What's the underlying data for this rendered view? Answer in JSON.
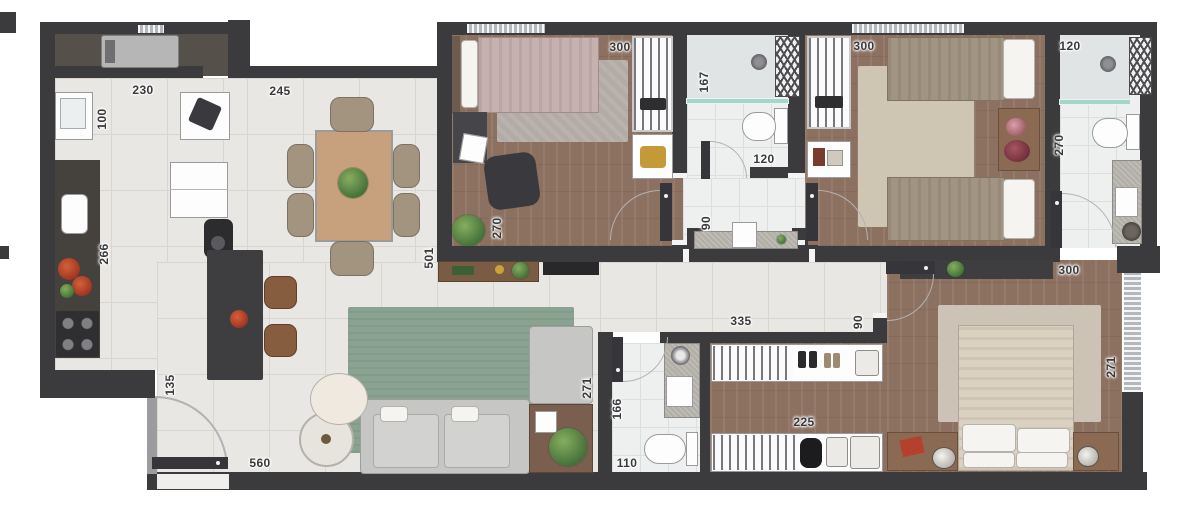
{
  "plan": {
    "kind": "residential apartment floor plan, top-down furnished render",
    "dimension_labels": [
      {
        "text": "230",
        "x": 143,
        "y": 90,
        "rot": 0
      },
      {
        "text": "100",
        "x": 102,
        "y": 119,
        "rot": -90
      },
      {
        "text": "245",
        "x": 280,
        "y": 91,
        "rot": 0
      },
      {
        "text": "266",
        "x": 104,
        "y": 254,
        "rot": -90
      },
      {
        "text": "135",
        "x": 170,
        "y": 385,
        "rot": -90
      },
      {
        "text": "560",
        "x": 260,
        "y": 463,
        "rot": 0
      },
      {
        "text": "501",
        "x": 429,
        "y": 258,
        "rot": -90
      },
      {
        "text": "270",
        "x": 497,
        "y": 228,
        "rot": -90
      },
      {
        "text": "300",
        "x": 620,
        "y": 47,
        "rot": 0
      },
      {
        "text": "167",
        "x": 704,
        "y": 82,
        "rot": -90
      },
      {
        "text": "120",
        "x": 764,
        "y": 159,
        "rot": 0
      },
      {
        "text": "90",
        "x": 706,
        "y": 223,
        "rot": -90
      },
      {
        "text": "300",
        "x": 864,
        "y": 46,
        "rot": 0
      },
      {
        "text": "120",
        "x": 1070,
        "y": 46,
        "rot": 0
      },
      {
        "text": "270",
        "x": 1059,
        "y": 145,
        "rot": -90
      },
      {
        "text": "335",
        "x": 741,
        "y": 321,
        "rot": 0
      },
      {
        "text": "90",
        "x": 858,
        "y": 322,
        "rot": -90
      },
      {
        "text": "300",
        "x": 1069,
        "y": 270,
        "rot": 0
      },
      {
        "text": "271",
        "x": 1111,
        "y": 367,
        "rot": -90
      },
      {
        "text": "225",
        "x": 804,
        "y": 422,
        "rot": 0
      },
      {
        "text": "166",
        "x": 617,
        "y": 409,
        "rot": -90
      },
      {
        "text": "110",
        "x": 627,
        "y": 463,
        "rot": 0
      },
      {
        "text": "271",
        "x": 587,
        "y": 388,
        "rot": -90
      }
    ]
  },
  "colors": {
    "wall": "#3b3b3e",
    "tile": "#e9e7e3",
    "tile_line": "#d9d5d0",
    "bath": "#eef0f0",
    "wood": "#8c7060",
    "laundry": "#56504b",
    "rug_living": "#8aa391",
    "rug_suite": "#ccc2b5",
    "rug_bed1": "#b3aca6",
    "rug_bed2": "#cfc5b3",
    "counter_dark": "#45413d",
    "island": "#3e3e41",
    "granite": "#b3afa9",
    "sofa": "#c6c6c4",
    "table_wood": "#c7a07e",
    "chair": "#a3947f",
    "bed_pink": "#c7b1af",
    "bed_taupe": "#a29482",
    "bed_cream": "#dbd1c1",
    "glass": "#a6d6cb",
    "window": "#b4b8bb",
    "accent_red": "#b5402e",
    "stool": "#875d3f",
    "side_wood": "#8a6a52",
    "arc": "#b2b2b4",
    "label_color": "#3a3a3d"
  }
}
